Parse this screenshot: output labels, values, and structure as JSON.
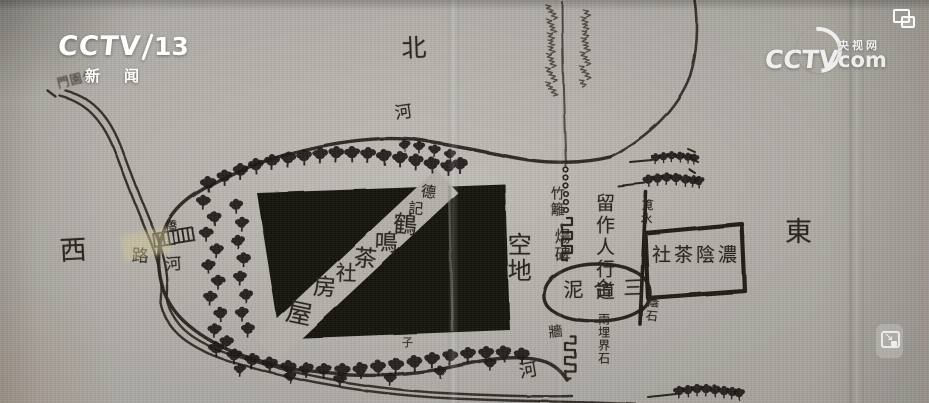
{
  "overlay": {
    "channel_logo": {
      "brand": "CCTV",
      "number": "13",
      "name_left": "新",
      "name_right": "闻"
    },
    "watermark": {
      "brand": "CCTV",
      "site_cn": "央视网",
      "site_com": "com"
    },
    "resize_arrow": "↘"
  },
  "map": {
    "compass": {
      "north": "北",
      "west": "西",
      "east": "東"
    },
    "water": {
      "river_top": "河",
      "river_left": "河",
      "river_bottom": "河"
    },
    "paths": {
      "road": "路",
      "bridge": "橋",
      "walkway_note": "留作人行道"
    },
    "gate_note": "門園公",
    "building": {
      "owner_mark": [
        "德",
        "記"
      ],
      "band_chars": [
        "鶴",
        "鳴",
        "茶",
        "社",
        "房"
      ],
      "band_end": "屋"
    },
    "features": {
      "empty_lot": "空地",
      "bamboo_fence": "竹籬",
      "stele": "煬碑",
      "water_conduit": "筧水",
      "teahouse_east": "社茶陰濃",
      "mortar_patch": "泥合三",
      "eave_stone": "蔭石",
      "boundary_stone": "兩埋界石",
      "wall": "牆",
      "tree_note": "子"
    }
  }
}
